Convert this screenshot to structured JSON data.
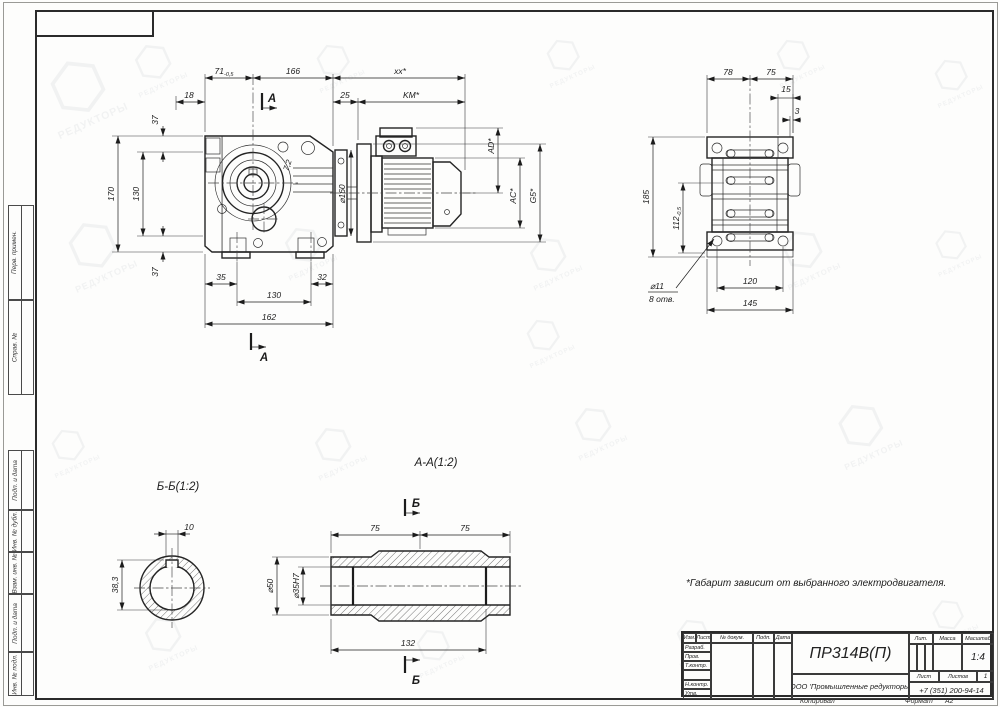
{
  "watermark": {
    "glyph": "⬡",
    "text": "РЕДУКТОРЫ"
  },
  "note": "*Габарит зависит от выбранного электродвигателя.",
  "frame": {
    "copied": "Копировал",
    "format_label": "Формат",
    "format_value": "А2",
    "margin_labels": [
      "Перв. примен.",
      "Справ. №",
      "Подп. и дата",
      "Инв. № дубл.",
      "Взам. инв. №",
      "Подп. и дата",
      "Инв. № подл."
    ]
  },
  "title_block": {
    "doc": "ПР314В(П)",
    "company": "ООО 'Промышленные редукторы'",
    "phone": "+7 (351) 200-94-14",
    "col_izm": "Изм.",
    "col_list": "Лист",
    "col_doc": "№ докум.",
    "col_podp": "Подп.",
    "col_data": "Дата",
    "row_razrab": "Разраб.",
    "row_prov": "Пров.",
    "row_tkontr": "Т.контр.",
    "row_nkontr": "Н.контр.",
    "row_utv": "Утв.",
    "lit": "Лит.",
    "mass": "Масса",
    "scale": "Масштаб",
    "scale_value": "1:4",
    "sheet": "Лист",
    "sheets": "Листов",
    "sheets_value": "1"
  },
  "main_view": {
    "section_letter": "А",
    "dims": {
      "d71": "71",
      "d71_tol": "-0,5",
      "d166": "166",
      "dxx": "xx*",
      "d18": "18",
      "d25": "25",
      "dkm": "KM*",
      "d37": "37",
      "d170": "170",
      "d130": "130",
      "d35": "35",
      "d32": "32",
      "d162": "162",
      "d72": "7,2",
      "d160": "⌀160",
      "dad": "AD*",
      "dac": "AC*",
      "dg5": "G5*"
    }
  },
  "side_view": {
    "dims": {
      "d78": "78",
      "d75": "75",
      "d15": "15",
      "d3": "3",
      "d185": "185",
      "d112": "112",
      "d112_tol": "-0,5",
      "d120": "120",
      "d145": "145",
      "dhole": "⌀11",
      "dholes": "8 отв."
    }
  },
  "section_bb": {
    "title": "Б-Б(1:2)",
    "dims": {
      "d10": "10",
      "d383": "38,3"
    }
  },
  "section_aa": {
    "title": "А-А(1:2)",
    "section_letter": "Б",
    "dims": {
      "d75l": "75",
      "d75r": "75",
      "d132": "132",
      "d50": "⌀50",
      "d35h7": "⌀35H7"
    }
  }
}
